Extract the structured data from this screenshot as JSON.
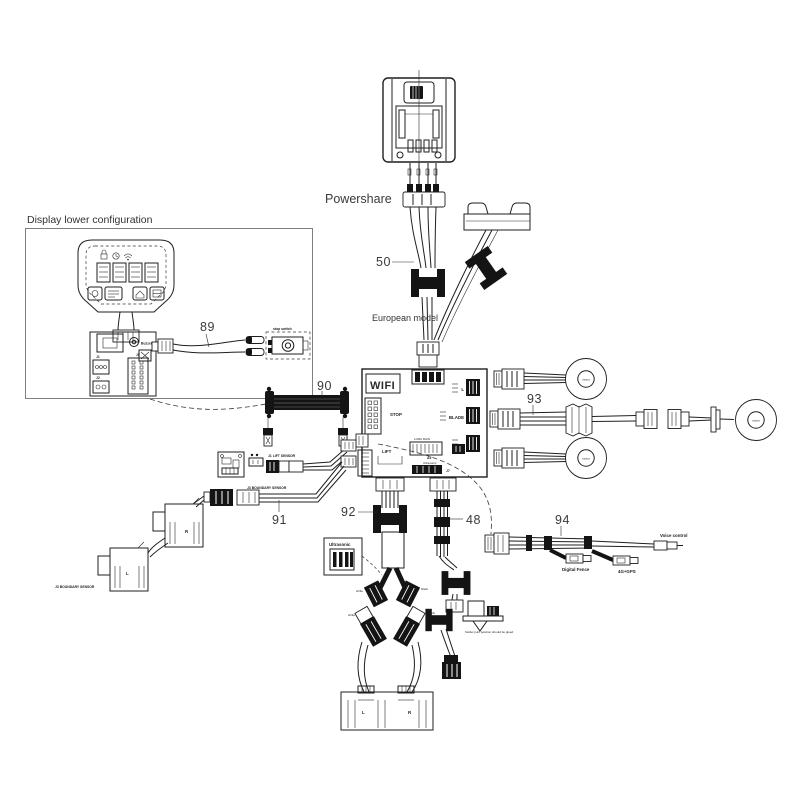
{
  "diagram": {
    "box_title": "Display lower configuration",
    "labels": {
      "powershare": "Powershare",
      "european_model": "European model",
      "stop_switch": "stop switch",
      "buzzer": "Buzzer",
      "j1": "J1",
      "j2": "J2",
      "j5": "J5",
      "j7": "J7",
      "wifi": "WIFI",
      "stop": "STOP",
      "lift": "LIFT",
      "blade": "BLADE",
      "lora_rain": "LORA RAIN",
      "a5": "A5",
      "ultrasonic": "Ultrasonic",
      "left_short": "L",
      "right_short": "R",
      "motor": "motor",
      "j1_lift_sensor": "J1 LIFT SENSOR",
      "j3_boundary_sensor": "J3 BOUNDARY SENSOR",
      "digital_fence": "Digital Fence",
      "gps_4g": "4G+GPS",
      "voice_control": "Voice control",
      "white": "white",
      "black": "black",
      "solder_note": "Solder joint position should be glued"
    },
    "part_numbers": {
      "n48": "48",
      "n50": "50",
      "n89": "89",
      "n90": "90",
      "n91": "91",
      "n92": "92",
      "n93": "93",
      "n94": "94"
    },
    "colors": {
      "line": "#1f1f1f",
      "background": "#ffffff"
    }
  }
}
